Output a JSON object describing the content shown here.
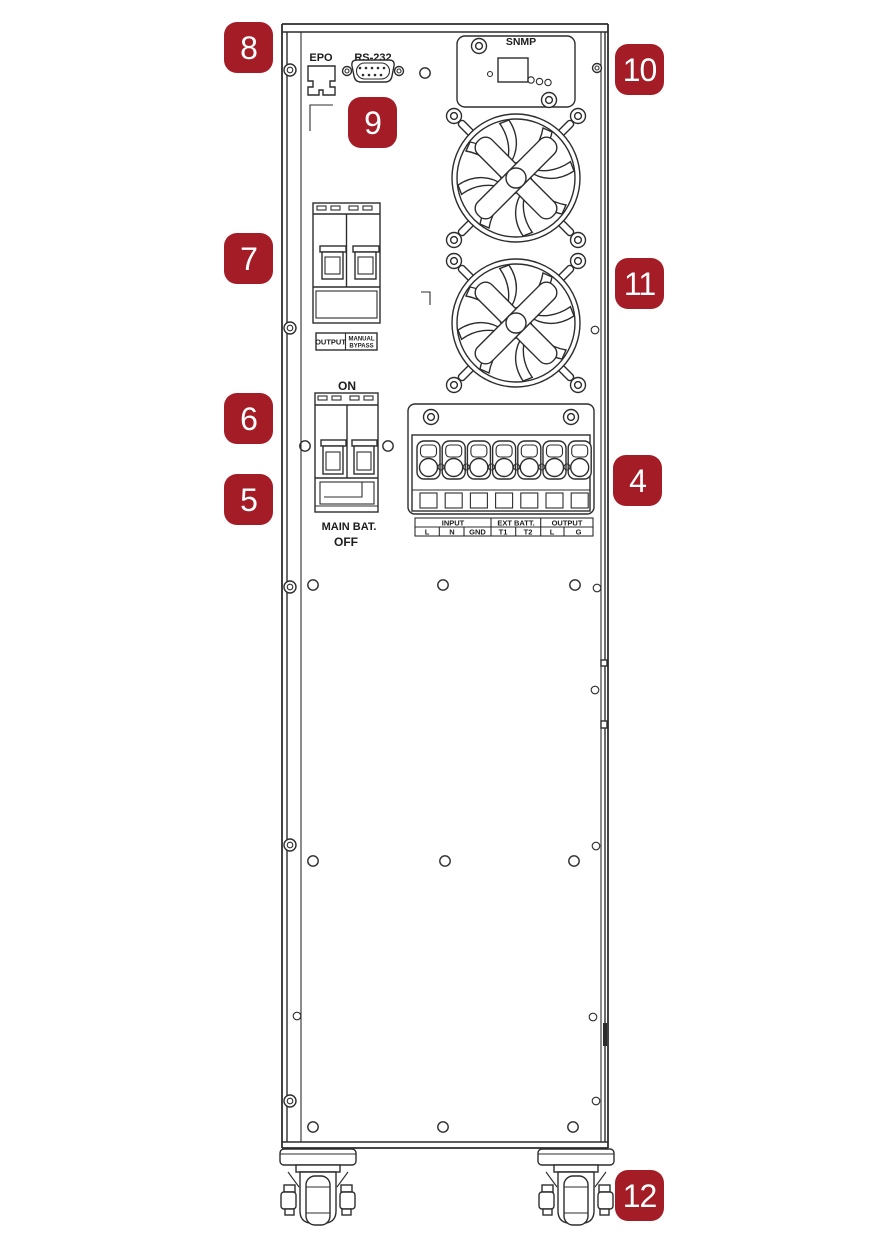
{
  "callouts": [
    {
      "label": "8"
    },
    {
      "label": "9"
    },
    {
      "label": "7"
    },
    {
      "label": "6"
    },
    {
      "label": "5"
    },
    {
      "label": "10"
    },
    {
      "label": "11"
    },
    {
      "label": "4"
    },
    {
      "label": "12"
    }
  ],
  "panel": {
    "epo_label": "EPO",
    "rs232_label": "RS-232",
    "snmp_label": "SNMP",
    "battery_breaker": {
      "on": "ON",
      "name": "MAIN BAT.",
      "off": "OFF"
    },
    "output_breaker": {
      "output": "OUTPUT",
      "bypass_line1": "MANUAL",
      "bypass_line2": "BYPASS"
    },
    "terminal_block": {
      "groups": [
        {
          "label": "INPUT"
        },
        {
          "label": "EXT BATT."
        },
        {
          "label": "OUTPUT"
        }
      ],
      "pins": [
        "L",
        "N",
        "GND",
        "T1",
        "T2",
        "L",
        "G"
      ]
    }
  },
  "colors": {
    "callout_background": "#A41D26",
    "callout_text": "#FFFFFF",
    "line_art": "#2D2D2D",
    "background": "#FFFFFF"
  }
}
